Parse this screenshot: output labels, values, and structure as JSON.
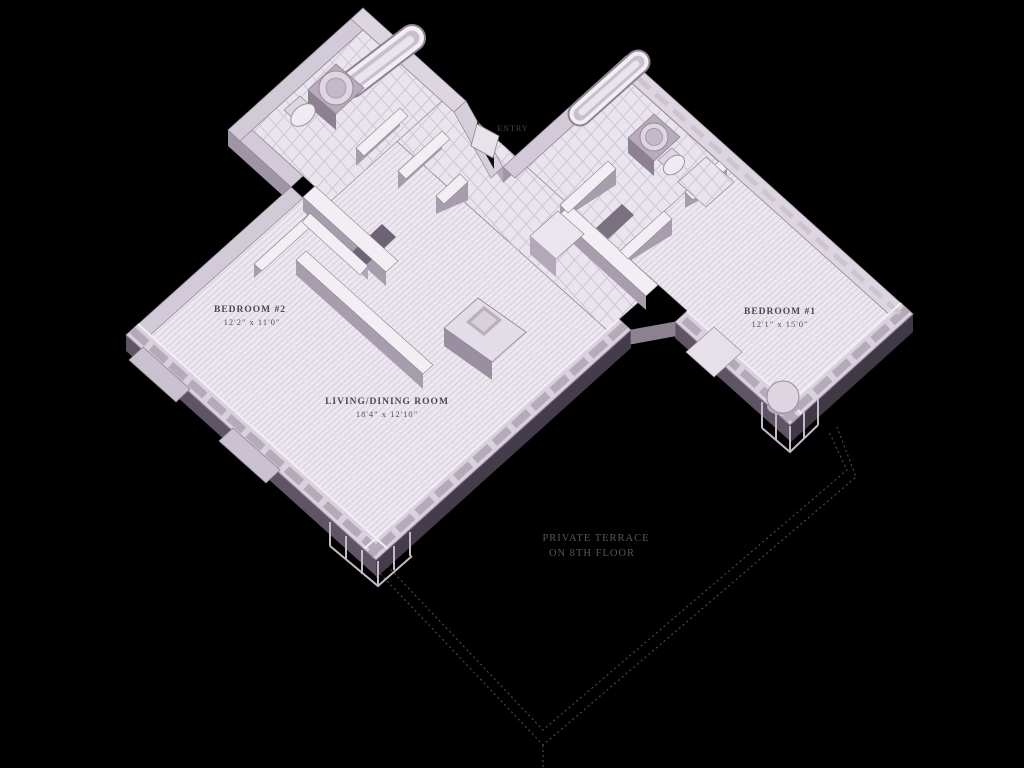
{
  "scene": {
    "type": "isometric apartment floor plan",
    "background_color": "#000000"
  },
  "palette": {
    "floor": "#ece8ef",
    "floor_hatch": "#d7cfdb",
    "wall_top": "#d2cad7",
    "wall_light_face": "#c4bac8",
    "wall_mid_face": "#a095a4",
    "wall_dark_face": "#3f3845",
    "interior_wall_top": "#f2eff4",
    "label_text": "#4f4754",
    "terrace_text": "#5b535e",
    "dotted_line": "#524c58"
  },
  "rooms": {
    "bedroom2": {
      "label": "BEDROOM #2",
      "dimensions": "12'2\" x 11'0\""
    },
    "living": {
      "label": "LIVING/DINING ROOM",
      "dimensions": "18'4\" x 12'10\""
    },
    "bedroom1": {
      "label": "BEDROOM #1",
      "dimensions": "12'1\" x 15'0\""
    },
    "entry": {
      "label": "ENTRY"
    },
    "terrace": {
      "label_line1": "PRIVATE TERRACE",
      "label_line2": "ON 8TH FLOOR"
    }
  }
}
